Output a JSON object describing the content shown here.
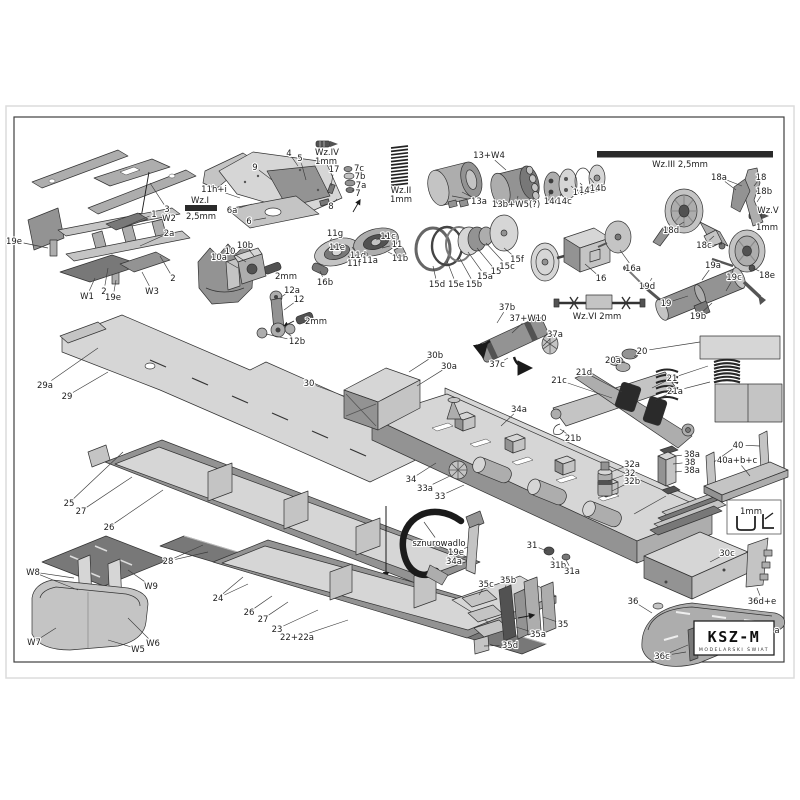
{
  "page": {
    "sheet_color": "#ffffff",
    "frame_color": "#3f3f3f",
    "edge_color": "#dcdcdc",
    "label_color": "#1c1c1c"
  },
  "logo": {
    "title": "KSZ-M",
    "subtitle": "MODELARSKI ŚWIAT"
  },
  "labels": [
    {
      "t": "3",
      "x": 167,
      "y": 209,
      "l": [
        [
          150,
          183
        ]
      ]
    },
    {
      "t": "1",
      "x": 154,
      "y": 214,
      "l": [
        [
          122,
          228
        ]
      ]
    },
    {
      "t": "W2",
      "x": 169,
      "y": 218,
      "l": [
        [
          132,
          226
        ]
      ]
    },
    {
      "t": "2a",
      "x": 169,
      "y": 233,
      "l": [
        [
          140,
          246
        ]
      ]
    },
    {
      "t": "2",
      "x": 173,
      "y": 278,
      "l": [
        [
          160,
          256
        ]
      ]
    },
    {
      "t": "19e",
      "x": 14,
      "y": 241,
      "l": [
        [
          48,
          248
        ]
      ]
    },
    {
      "t": "W1",
      "x": 87,
      "y": 296,
      "l": [
        [
          95,
          278
        ]
      ]
    },
    {
      "t": "2",
      "x": 104,
      "y": 291,
      "l": [
        [
          108,
          268
        ]
      ]
    },
    {
      "t": "19e",
      "x": 113,
      "y": 297,
      "l": [
        [
          116,
          280
        ]
      ]
    },
    {
      "t": "W3",
      "x": 152,
      "y": 291,
      "l": [
        [
          142,
          272
        ]
      ]
    },
    {
      "t": "9",
      "x": 255,
      "y": 167,
      "l": [
        [
          272,
          180
        ]
      ]
    },
    {
      "t": "4",
      "x": 289,
      "y": 153,
      "l": [
        [
          298,
          166
        ]
      ]
    },
    {
      "t": "5",
      "x": 300,
      "y": 158,
      "l": [
        [
          306,
          180
        ]
      ]
    },
    {
      "t": "17",
      "x": 334,
      "y": 169,
      "l": [
        [
          331,
          186
        ]
      ]
    },
    {
      "t": "7c",
      "x": 359,
      "y": 168,
      "l": [
        [
          352,
          170
        ]
      ]
    },
    {
      "t": "7b",
      "x": 360,
      "y": 176,
      "l": [
        [
          354,
          177
        ]
      ]
    },
    {
      "t": "7a",
      "x": 361,
      "y": 185,
      "l": [
        [
          355,
          184
        ]
      ]
    },
    {
      "t": "7",
      "x": 358,
      "y": 193,
      "l": [
        [
          352,
          190
        ]
      ]
    },
    {
      "t": "8",
      "x": 331,
      "y": 206,
      "l": [
        [
          337,
          199
        ]
      ]
    },
    {
      "t": "11h+i",
      "x": 214,
      "y": 189,
      "l": [
        [
          240,
          198
        ]
      ]
    },
    {
      "t": "6a",
      "x": 232,
      "y": 210,
      "l": [
        [
          252,
          204
        ]
      ]
    },
    {
      "t": "6",
      "x": 249,
      "y": 221,
      "l": [
        [
          266,
          218
        ]
      ]
    },
    {
      "t": "Wz.I",
      "x": 200,
      "y": 200
    },
    {
      "t": "2,5mm",
      "x": 201,
      "y": 216
    },
    {
      "t": "Wz.IV",
      "x": 327,
      "y": 152
    },
    {
      "t": "1mm",
      "x": 326,
      "y": 161
    },
    {
      "t": "Wz.II",
      "x": 401,
      "y": 190
    },
    {
      "t": "1mm",
      "x": 401,
      "y": 199
    },
    {
      "t": "10b",
      "x": 245,
      "y": 245,
      "l": [
        [
          254,
          256
        ]
      ]
    },
    {
      "t": "10",
      "x": 230,
      "y": 251,
      "l": [
        [
          246,
          262
        ]
      ]
    },
    {
      "t": "10a",
      "x": 219,
      "y": 257,
      "l": [
        [
          238,
          268
        ]
      ]
    },
    {
      "t": "2mm",
      "x": 286,
      "y": 276
    },
    {
      "t": "12a",
      "x": 292,
      "y": 290,
      "l": [
        [
          281,
          297
        ]
      ]
    },
    {
      "t": "12",
      "x": 299,
      "y": 299,
      "l": [
        [
          284,
          310
        ]
      ]
    },
    {
      "t": "2mm",
      "x": 316,
      "y": 321
    },
    {
      "t": "12b",
      "x": 297,
      "y": 341,
      "l": [
        [
          266,
          334
        ],
        [
          286,
          332
        ]
      ]
    },
    {
      "t": "16b",
      "x": 325,
      "y": 282,
      "l": [
        [
          320,
          271
        ]
      ]
    },
    {
      "t": "11g",
      "x": 335,
      "y": 233,
      "l": [
        [
          330,
          241
        ]
      ]
    },
    {
      "t": "11c",
      "x": 388,
      "y": 236,
      "l": [
        [
          376,
          240
        ]
      ]
    },
    {
      "t": "11",
      "x": 397,
      "y": 244,
      "l": [
        [
          382,
          248
        ]
      ]
    },
    {
      "t": "11e",
      "x": 337,
      "y": 247,
      "l": [
        [
          333,
          252
        ]
      ]
    },
    {
      "t": "11d",
      "x": 358,
      "y": 255,
      "l": [
        [
          352,
          247
        ]
      ]
    },
    {
      "t": "11a",
      "x": 370,
      "y": 260,
      "l": [
        [
          366,
          251
        ]
      ]
    },
    {
      "t": "11b",
      "x": 400,
      "y": 258,
      "l": [
        [
          388,
          252
        ]
      ]
    },
    {
      "t": "11f",
      "x": 354,
      "y": 263,
      "l": [
        [
          348,
          256
        ]
      ]
    },
    {
      "t": "13+W4",
      "x": 489,
      "y": 155,
      "l": [
        [
          506,
          170
        ]
      ]
    },
    {
      "t": "13a",
      "x": 479,
      "y": 201,
      "l": [
        [
          452,
          196
        ],
        [
          462,
          192
        ]
      ]
    },
    {
      "t": "13b+W5(?)",
      "x": 516,
      "y": 204,
      "l": [
        [
          518,
          196
        ]
      ]
    },
    {
      "t": "14d",
      "x": 552,
      "y": 201,
      "l": [
        [
          549,
          194
        ]
      ]
    },
    {
      "t": "14c",
      "x": 564,
      "y": 201,
      "l": [
        [
          561,
          194
        ]
      ]
    },
    {
      "t": "14",
      "x": 578,
      "y": 192,
      "l": [
        [
          571,
          186
        ]
      ]
    },
    {
      "t": "14a",
      "x": 587,
      "y": 190,
      "l": [
        [
          580,
          183
        ]
      ]
    },
    {
      "t": "14b",
      "x": 598,
      "y": 188,
      "l": [
        [
          590,
          178
        ]
      ]
    },
    {
      "t": "Wz.III  2,5mm",
      "x": 680,
      "y": 164
    },
    {
      "t": "18a",
      "x": 719,
      "y": 177,
      "l": [
        [
          736,
          190
        ],
        [
          742,
          186
        ]
      ]
    },
    {
      "t": "18",
      "x": 761,
      "y": 177,
      "l": [
        [
          754,
          186
        ]
      ]
    },
    {
      "t": "18b",
      "x": 764,
      "y": 191,
      "l": [
        [
          757,
          202
        ]
      ]
    },
    {
      "t": "Wz.V",
      "x": 768,
      "y": 210
    },
    {
      "t": "1mm",
      "x": 767,
      "y": 227
    },
    {
      "t": "18d",
      "x": 671,
      "y": 230,
      "l": [
        [
          684,
          222
        ]
      ]
    },
    {
      "t": "18c",
      "x": 704,
      "y": 245,
      "l": [
        [
          714,
          236
        ],
        [
          722,
          244
        ]
      ]
    },
    {
      "t": "18e",
      "x": 767,
      "y": 275,
      "l": [
        [
          753,
          268
        ]
      ]
    },
    {
      "t": "15d",
      "x": 437,
      "y": 284,
      "l": [
        [
          433,
          266
        ]
      ]
    },
    {
      "t": "15e",
      "x": 456,
      "y": 284,
      "l": [
        [
          447,
          261
        ]
      ]
    },
    {
      "t": "15b",
      "x": 474,
      "y": 284,
      "l": [
        [
          459,
          257
        ]
      ]
    },
    {
      "t": "15a",
      "x": 485,
      "y": 276,
      "l": [
        [
          468,
          252
        ]
      ]
    },
    {
      "t": "15",
      "x": 496,
      "y": 271,
      "l": [
        [
          477,
          248
        ]
      ]
    },
    {
      "t": "15c",
      "x": 507,
      "y": 266,
      "l": [
        [
          486,
          243
        ]
      ]
    },
    {
      "t": "15f",
      "x": 517,
      "y": 259,
      "l": [
        [
          504,
          248
        ]
      ]
    },
    {
      "t": "16",
      "x": 601,
      "y": 278,
      "l": [
        [
          585,
          264
        ]
      ]
    },
    {
      "t": "16a",
      "x": 633,
      "y": 268,
      "l": [
        [
          620,
          250
        ]
      ]
    },
    {
      "t": "19d",
      "x": 647,
      "y": 286,
      "l": [
        [
          652,
          278
        ]
      ]
    },
    {
      "t": "19a",
      "x": 713,
      "y": 265,
      "l": [
        [
          702,
          280
        ]
      ]
    },
    {
      "t": "19c",
      "x": 734,
      "y": 277,
      "l": [
        [
          726,
          291
        ]
      ]
    },
    {
      "t": "19",
      "x": 666,
      "y": 303,
      "l": [
        [
          688,
          296
        ]
      ]
    },
    {
      "t": "19b",
      "x": 698,
      "y": 316,
      "l": [
        [
          712,
          303
        ]
      ]
    },
    {
      "t": "Wz.VI 2mm",
      "x": 597,
      "y": 316
    },
    {
      "t": "37b",
      "x": 507,
      "y": 307,
      "l": [
        [
          497,
          323
        ]
      ]
    },
    {
      "t": "37+W10",
      "x": 528,
      "y": 318,
      "l": [
        [
          512,
          333
        ]
      ]
    },
    {
      "t": "37a",
      "x": 555,
      "y": 334,
      "l": [
        [
          543,
          346
        ]
      ]
    },
    {
      "t": "37c",
      "x": 497,
      "y": 364,
      "l": [
        [
          508,
          358
        ]
      ]
    },
    {
      "t": "20a",
      "x": 613,
      "y": 360,
      "l": [
        [
          625,
          362
        ]
      ]
    },
    {
      "t": "20",
      "x": 642,
      "y": 351,
      "l": [
        [
          634,
          357
        ],
        [
          700,
          342
        ]
      ]
    },
    {
      "t": "21d",
      "x": 584,
      "y": 372,
      "l": [
        [
          622,
          392
        ]
      ]
    },
    {
      "t": "21c",
      "x": 559,
      "y": 380,
      "l": [
        [
          612,
          398
        ]
      ]
    },
    {
      "t": "21",
      "x": 672,
      "y": 378,
      "l": [
        [
          652,
          388
        ],
        [
          708,
          366
        ]
      ]
    },
    {
      "t": "21a",
      "x": 675,
      "y": 391,
      "l": [
        [
          655,
          400
        ],
        [
          710,
          382
        ]
      ]
    },
    {
      "t": "21b",
      "x": 573,
      "y": 438,
      "l": [
        [
          560,
          429
        ]
      ]
    },
    {
      "t": "29a",
      "x": 45,
      "y": 385,
      "l": [
        [
          98,
          348
        ]
      ]
    },
    {
      "t": "29",
      "x": 67,
      "y": 396,
      "l": [
        [
          108,
          372
        ]
      ]
    },
    {
      "t": "30",
      "x": 309,
      "y": 383,
      "l": [
        [
          344,
          396
        ]
      ]
    },
    {
      "t": "30b",
      "x": 435,
      "y": 355,
      "l": [
        [
          409,
          372
        ]
      ]
    },
    {
      "t": "30a",
      "x": 449,
      "y": 366,
      "l": [
        [
          417,
          386
        ]
      ]
    },
    {
      "t": "25",
      "x": 69,
      "y": 503,
      "l": [
        [
          123,
          452
        ]
      ]
    },
    {
      "t": "27",
      "x": 81,
      "y": 511,
      "l": [
        [
          132,
          477
        ]
      ]
    },
    {
      "t": "26",
      "x": 109,
      "y": 527,
      "l": [
        [
          163,
          490
        ]
      ]
    },
    {
      "t": "34",
      "x": 411,
      "y": 479,
      "l": [
        [
          436,
          463
        ]
      ]
    },
    {
      "t": "33a",
      "x": 425,
      "y": 488,
      "l": [
        [
          450,
          476
        ]
      ]
    },
    {
      "t": "33",
      "x": 440,
      "y": 496,
      "l": [
        [
          464,
          485
        ]
      ]
    },
    {
      "t": "34a",
      "x": 519,
      "y": 409,
      "l": [
        [
          501,
          426
        ]
      ]
    },
    {
      "t": "32a",
      "x": 632,
      "y": 464,
      "l": [
        [
          611,
          472
        ]
      ]
    },
    {
      "t": "32",
      "x": 630,
      "y": 473,
      "l": [
        [
          608,
          481
        ]
      ]
    },
    {
      "t": "32b",
      "x": 632,
      "y": 481,
      "l": [
        [
          612,
          491
        ]
      ]
    },
    {
      "t": "38a",
      "x": 692,
      "y": 454,
      "l": [
        [
          675,
          456
        ]
      ]
    },
    {
      "t": "38",
      "x": 690,
      "y": 462,
      "l": [
        [
          673,
          464
        ]
      ]
    },
    {
      "t": "38a",
      "x": 692,
      "y": 470,
      "l": [
        [
          675,
          472
        ]
      ]
    },
    {
      "t": "40",
      "x": 738,
      "y": 445,
      "l": [
        [
          714,
          462
        ],
        [
          760,
          446
        ]
      ]
    },
    {
      "t": "40a+b+c",
      "x": 737,
      "y": 460,
      "l": [
        [
          750,
          476
        ]
      ]
    },
    {
      "t": "31",
      "x": 532,
      "y": 545,
      "l": [
        [
          547,
          551
        ]
      ]
    },
    {
      "t": "31b",
      "x": 558,
      "y": 565,
      "l": [
        [
          552,
          557
        ]
      ]
    },
    {
      "t": "31a",
      "x": 572,
      "y": 571,
      "l": [
        [
          566,
          560
        ]
      ]
    },
    {
      "t": "30c",
      "x": 727,
      "y": 553,
      "l": [
        [
          710,
          562
        ]
      ]
    },
    {
      "t": "1mm",
      "x": 751,
      "y": 511
    },
    {
      "t": "sznurowadlo",
      "x": 439,
      "y": 543,
      "l": [
        [
          424,
          522
        ]
      ]
    },
    {
      "t": "19e",
      "x": 456,
      "y": 552,
      "l": [
        [
          468,
          547
        ]
      ]
    },
    {
      "t": "34a",
      "x": 454,
      "y": 561,
      "l": [
        [
          466,
          557
        ]
      ]
    },
    {
      "t": "35c",
      "x": 486,
      "y": 584,
      "l": [
        [
          479,
          595
        ]
      ]
    },
    {
      "t": "35b",
      "x": 508,
      "y": 580,
      "l": [
        [
          505,
          588
        ]
      ]
    },
    {
      "t": "35",
      "x": 563,
      "y": 624,
      "l": [
        [
          543,
          617
        ]
      ]
    },
    {
      "t": "35a",
      "x": 538,
      "y": 634,
      "l": [
        [
          516,
          627
        ]
      ]
    },
    {
      "t": "35d",
      "x": 510,
      "y": 645,
      "l": [
        [
          484,
          646
        ]
      ]
    },
    {
      "t": "36",
      "x": 633,
      "y": 601,
      "l": [
        [
          652,
          613
        ]
      ]
    },
    {
      "t": "36d+e",
      "x": 762,
      "y": 601,
      "l": [
        [
          757,
          588
        ]
      ]
    },
    {
      "t": "36c",
      "x": 662,
      "y": 656,
      "l": [
        [
          686,
          652
        ],
        [
          688,
          645
        ]
      ]
    },
    {
      "t": "a",
      "x": 777,
      "y": 630
    },
    {
      "t": "28",
      "x": 168,
      "y": 561,
      "l": [
        [
          203,
          545
        ],
        [
          208,
          552
        ]
      ]
    },
    {
      "t": "24",
      "x": 218,
      "y": 598,
      "l": [
        [
          243,
          577
        ],
        [
          248,
          584
        ]
      ]
    },
    {
      "t": "26",
      "x": 249,
      "y": 612,
      "l": [
        [
          272,
          596
        ]
      ]
    },
    {
      "t": "27",
      "x": 263,
      "y": 619,
      "l": [
        [
          288,
          602
        ]
      ]
    },
    {
      "t": "23",
      "x": 277,
      "y": 629,
      "l": [
        [
          318,
          610
        ]
      ]
    },
    {
      "t": "22+22a",
      "x": 297,
      "y": 637,
      "l": [
        [
          348,
          620
        ]
      ]
    },
    {
      "t": "W8",
      "x": 33,
      "y": 572,
      "l": [
        [
          74,
          578
        ],
        [
          78,
          590
        ]
      ]
    },
    {
      "t": "W9",
      "x": 151,
      "y": 586,
      "l": [
        [
          128,
          570
        ]
      ]
    },
    {
      "t": "W7",
      "x": 34,
      "y": 642,
      "l": [
        [
          56,
          628
        ]
      ]
    },
    {
      "t": "W6",
      "x": 153,
      "y": 643,
      "l": [
        [
          128,
          618
        ]
      ]
    },
    {
      "t": "W5",
      "x": 138,
      "y": 649,
      "l": [
        [
          108,
          640
        ]
      ]
    }
  ]
}
